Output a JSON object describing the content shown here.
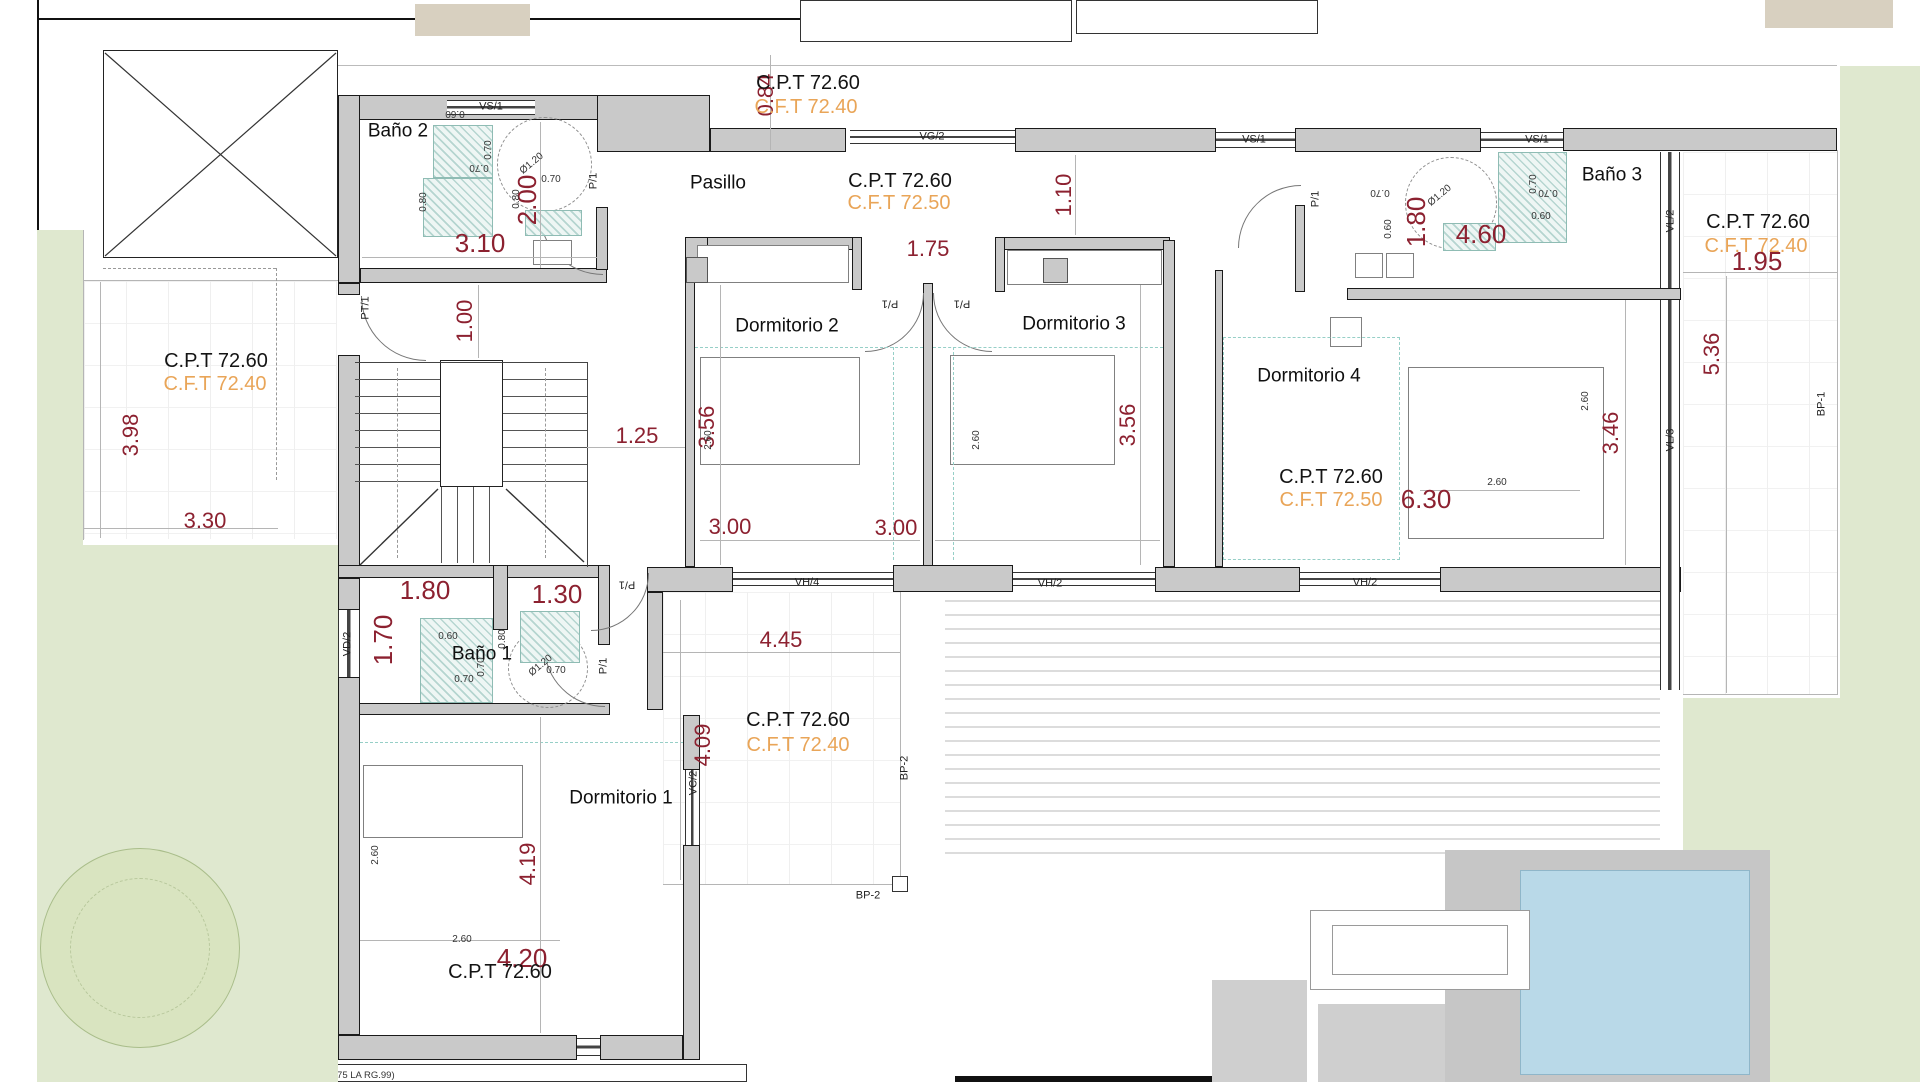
{
  "rooms": {
    "bano1": "Baño 1",
    "bano2": "Baño 2",
    "bano3": "Baño 3",
    "pasillo": "Pasillo",
    "dorm1": "Dormitorio 1",
    "dorm2": "Dormitorio 2",
    "dorm3": "Dormitorio 3",
    "dorm4": "Dormitorio 4"
  },
  "levels": {
    "cpt": "C.P.T 72.60",
    "cft40": "C.F.T 72.40",
    "cft50": "C.F.T 72.50"
  },
  "dims": {
    "d084": "0.84",
    "d110": "1.10",
    "d175": "1.75",
    "d200": "2.00",
    "d310": "3.10",
    "d100": "1.00",
    "d125": "1.25",
    "d398": "3.98",
    "d330": "3.30",
    "d356": "3.56",
    "d300": "3.00",
    "d630": "6.30",
    "d346": "3.46",
    "d536": "5.36",
    "d195": "1.95",
    "d180": "1.80",
    "d460": "4.60",
    "d130": "1.30",
    "d170": "1.70",
    "d445": "4.45",
    "d409": "4.09",
    "d419": "4.19",
    "d420": "4.20",
    "d260": "2.60",
    "d070": "0.70",
    "d060": "0.60",
    "d080": "0.80",
    "dia120": "Ø1.20"
  },
  "openings": {
    "vs1": "VS/1",
    "vg2": "VG/2",
    "vh4": "VH/4",
    "vh2": "VH/2",
    "vd2": "VD/2",
    "vc2": "VC/2",
    "vl2": "VL/2",
    "vl3": "VL/3",
    "bp1": "BP-1",
    "bp2": "BP-2",
    "p1": "P/1",
    "pt1": "PT/1"
  },
  "colors": {
    "dim_red": "#8c2130",
    "cft_orange": "#e9a558",
    "wall_gray": "#c9c9c9",
    "hatch_teal": "#8fbcb4",
    "garden_green": "#dfe8cf",
    "pool_blue": "#b9d9e8"
  },
  "footnote": "VERIFICACION VENTILACION (ARTICULO 40.75 LA RG.99)"
}
